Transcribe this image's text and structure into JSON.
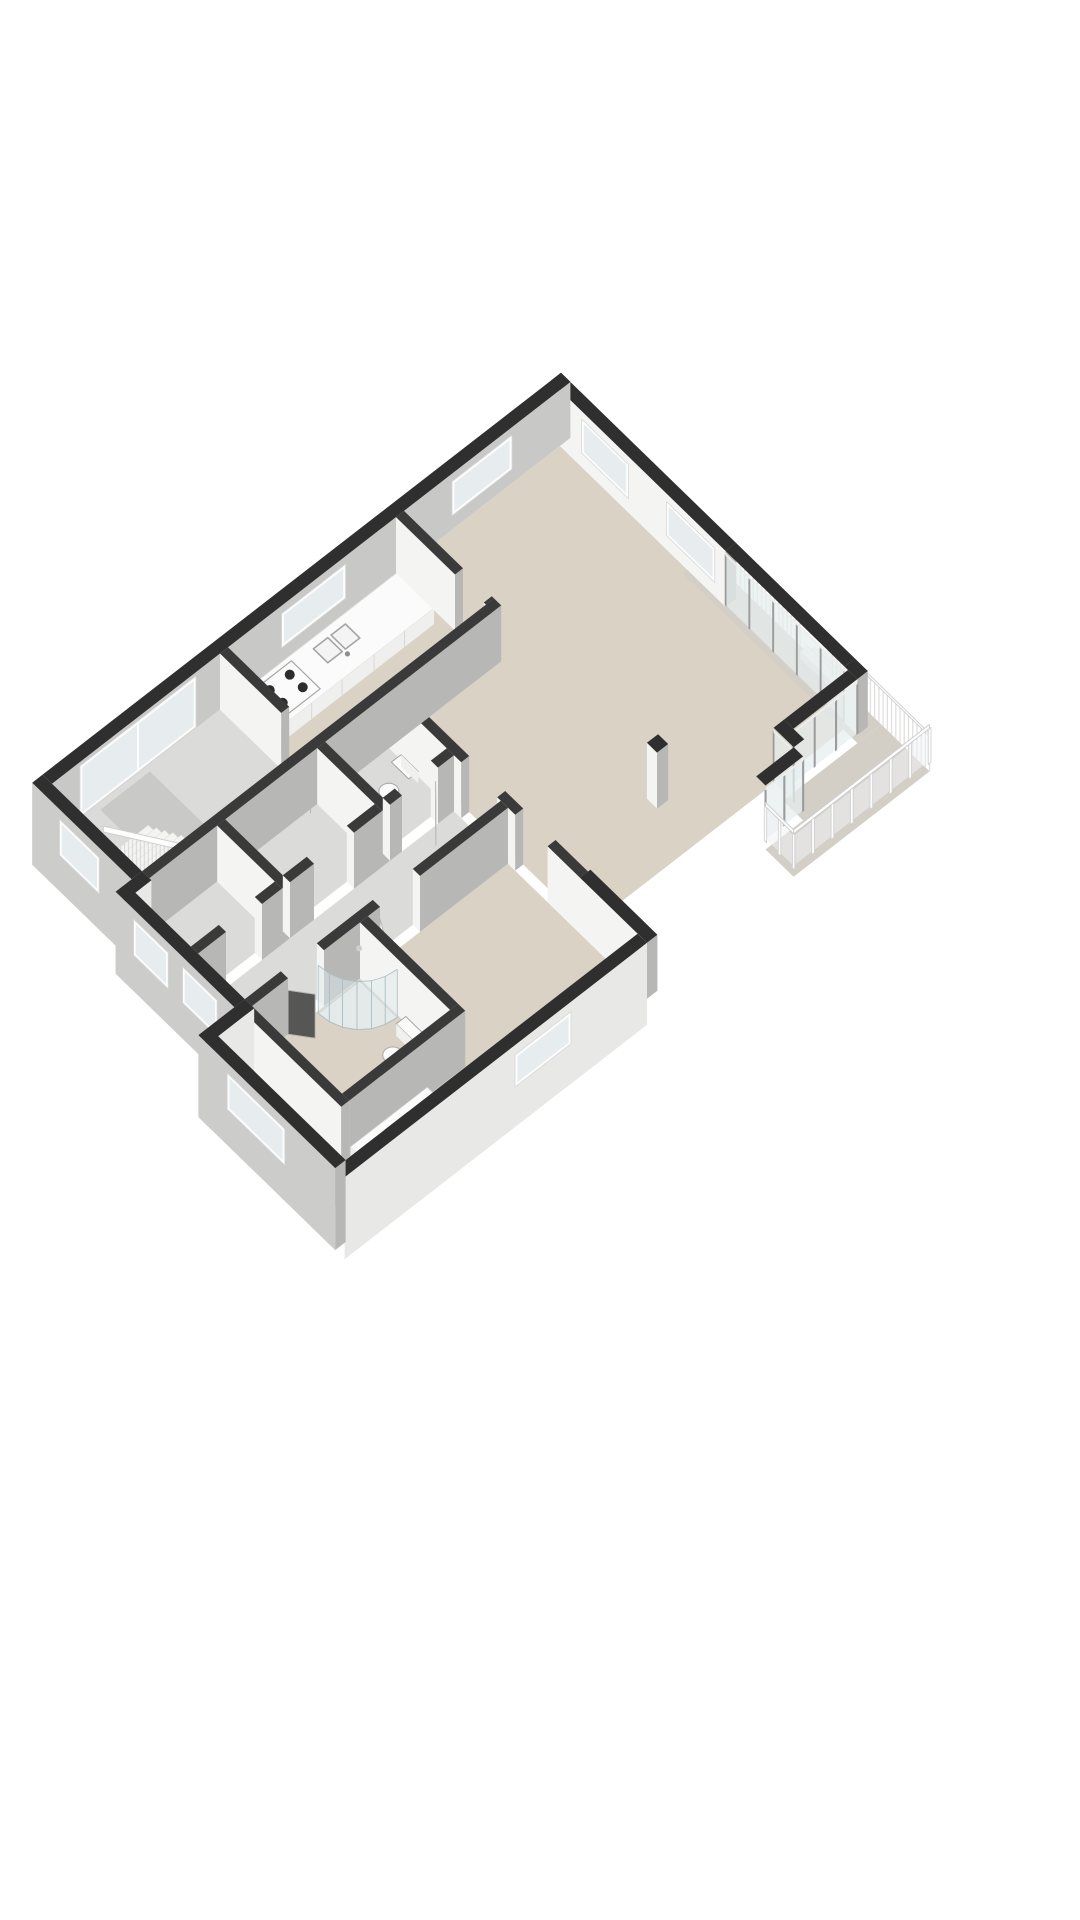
{
  "scene": {
    "title": "3D floor plan (axonometric view)",
    "type": "3d-floor-plan",
    "background": "#ffffff"
  },
  "palette": {
    "wall_top_ext": "#2f2f2f",
    "wall_top_int": "#3a3a3a",
    "face_south": "#f4f4f3",
    "face_east": "#b7b7b6",
    "facade_inner_gray": "#c8c8c7",
    "facade_ext_gray": "#cccccb",
    "facade_ext_east": "#e8e8e7",
    "floor_beige": "#d9d2c5",
    "floor_gray": "#dbdcd9",
    "floor_terrace": "#d4cfc6",
    "floor_pit": "#c9c9c7",
    "glass": "#e6edef",
    "glass_frame": "#9b9b9b",
    "railing_white": "#fdfdfd",
    "railing_stroke": "#cdcdcd",
    "fixture_white": "#fbfbfb",
    "fixture_stroke": "#a5a5a5",
    "tread_top": "#f4f4f3",
    "tread_face": "#e3e3e2",
    "counter_face": "#efefee",
    "burner_dark": "#2d2d2d",
    "door_dark": "#565655",
    "door_white": "#fdfdfd",
    "window_frame": "#fdfdfd",
    "window_glass": "#e7edef"
  },
  "rooms": [
    {
      "name": "living-room",
      "floor": "floor_beige"
    },
    {
      "name": "kitchen",
      "floor": "floor_beige"
    },
    {
      "name": "hallway-stairs",
      "floor": "floor_gray"
    },
    {
      "name": "wc",
      "floor": "floor_gray"
    },
    {
      "name": "closet-a",
      "floor": "floor_gray"
    },
    {
      "name": "closet-b",
      "floor": "floor_gray"
    },
    {
      "name": "corridor",
      "floor": "floor_gray"
    },
    {
      "name": "bathroom",
      "floor": "floor_beige"
    },
    {
      "name": "bedroom",
      "floor": "floor_beige"
    },
    {
      "name": "terrace",
      "floor": "floor_terrace"
    },
    {
      "name": "balcony-strip",
      "floor": "floor_terrace"
    }
  ],
  "fixtures": [
    "kitchen-counter",
    "kitchen-sink",
    "cooktop",
    "staircase",
    "stair-railing",
    "shower",
    "toilet",
    "wc-toilet",
    "vanity-sink",
    "column",
    "terrace-railing",
    "glass-balustrade",
    "exterior-steps",
    "sliding-glass-doors",
    "interior-doors",
    "windows"
  ]
}
